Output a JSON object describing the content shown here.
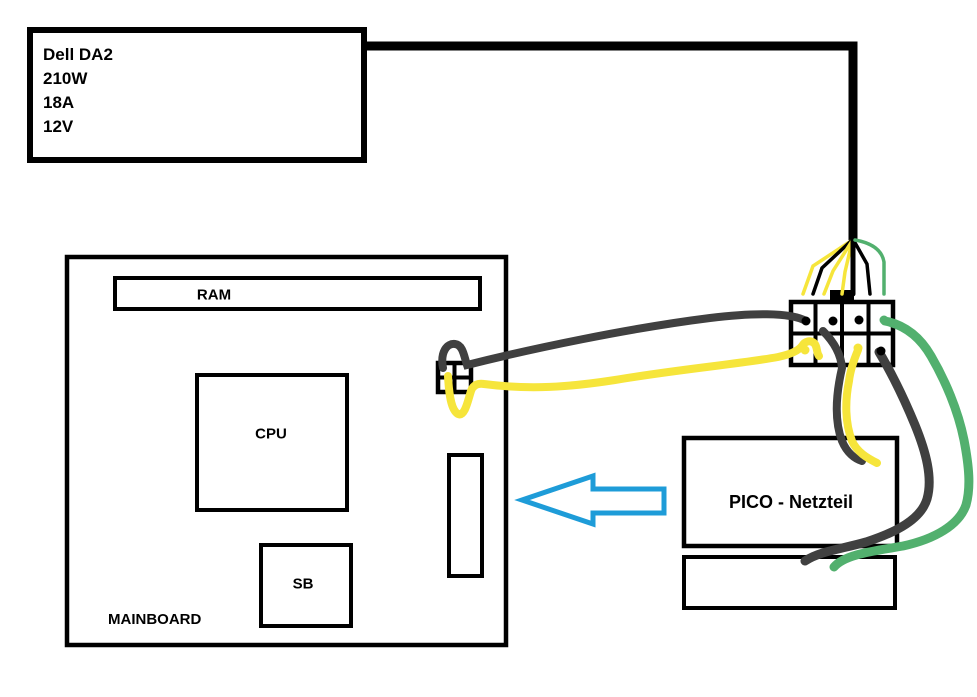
{
  "psu_box": {
    "lines": [
      "Dell DA2",
      "210W",
      "18A",
      "12V"
    ]
  },
  "mainboard": {
    "label": "MAINBOARD",
    "ram_label": "RAM",
    "cpu_label": "CPU",
    "sb_label": "SB"
  },
  "pico": {
    "label": "PICO - Netzteil"
  },
  "colors": {
    "black": "#000000",
    "wire_gray": "#404040",
    "wire_yellow": "#f6e53b",
    "wire_green": "#52b06e",
    "arrow_blue": "#1e9cd8"
  }
}
